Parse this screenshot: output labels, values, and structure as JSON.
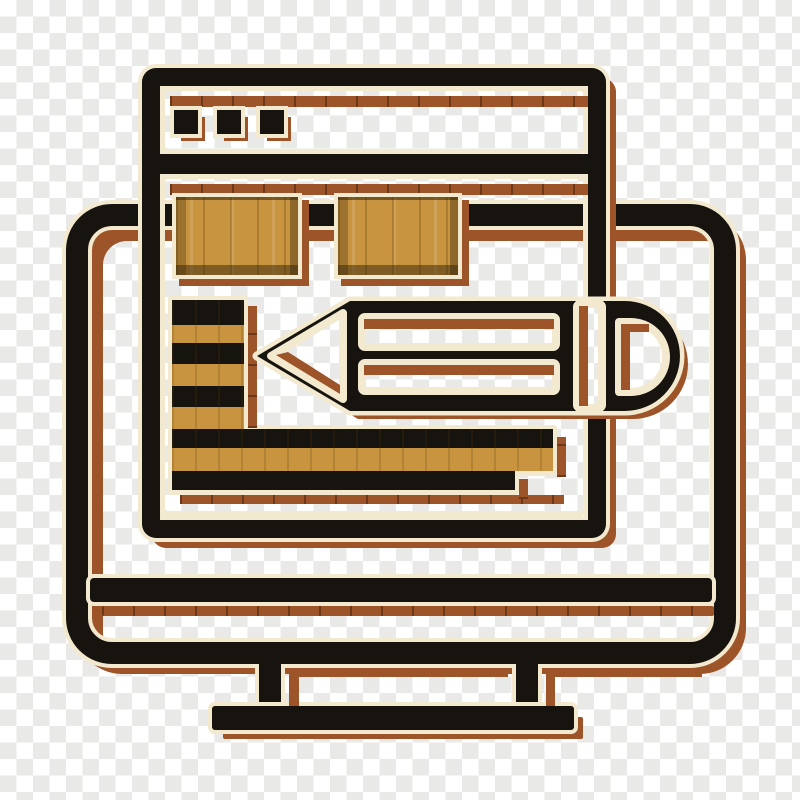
{
  "scene": {
    "type": "icon",
    "description": "Flat line-art icon of a desktop computer monitor displaying a browser window with two content blocks, a striped list and a large horizontal pencil, drawn on a transparency checkerboard",
    "background": "transparency-checkerboard"
  },
  "palette": {
    "black": "#17130e",
    "cream": "#f2e9cf",
    "sienna": "#9c5428",
    "sienna_dark": "#6e3a18",
    "wood": "#c89440",
    "wood_dark": "#8f6a22",
    "wood_light": "#dcae5b",
    "checker_gray": "#e9e9e7",
    "checker_white": "#ffffff"
  },
  "icon": {
    "monitor": {
      "label": "monitor with stand"
    },
    "browser": {
      "label": "browser window",
      "window_buttons": 3
    },
    "content": {
      "image_blocks": 2,
      "list_stripes": 6,
      "wide_bars": 3
    },
    "pencil": {
      "label": "pencil",
      "orientation": "horizontal",
      "tip": "left",
      "eraser": "right"
    }
  }
}
